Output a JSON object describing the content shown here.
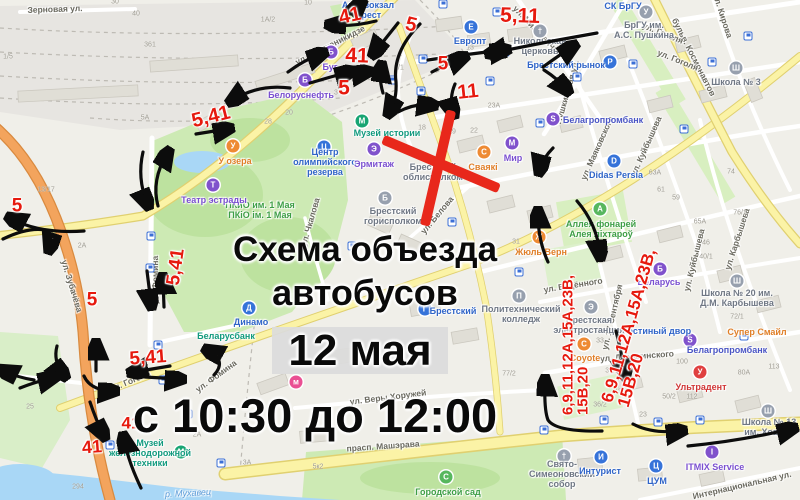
{
  "title": {
    "line1": "Схема объезда",
    "line2": "автобусов",
    "date": "12 мая",
    "time": "с 10:30 до 12:00"
  },
  "colors": {
    "route_red": "#e6190e",
    "cross_red": "#e8281b",
    "arrow_black": "#0c0c0c",
    "road_yellow": "#fbf3a6",
    "road_orange": "#f3a45d",
    "park_green": "#cdeab4",
    "water_blue": "#a9d7f6",
    "poi_blue": "#3673d9",
    "poi_violet": "#8052cc",
    "poi_orange": "#ee8a33",
    "poi_green": "#57b75e",
    "poi_teal": "#18a573",
    "poi_gray": "#97a0ae",
    "poi_red": "#e04040",
    "poi_pink": "#ea4f93"
  },
  "overlay": {
    "route_labels": [
      {
        "t": "41",
        "x": 350,
        "y": 16,
        "r": -12,
        "s": 20
      },
      {
        "t": "5",
        "x": 411,
        "y": 25,
        "r": 14,
        "s": 20
      },
      {
        "t": "5,11",
        "x": 520,
        "y": 16,
        "r": 2,
        "s": 21
      },
      {
        "t": "41",
        "x": 357,
        "y": 56,
        "r": 2,
        "s": 21
      },
      {
        "t": "5",
        "x": 344,
        "y": 88,
        "r": 0,
        "s": 21
      },
      {
        "t": "5",
        "x": 443,
        "y": 64,
        "r": 0,
        "s": 19
      },
      {
        "t": "11",
        "x": 468,
        "y": 92,
        "r": -6,
        "s": 20
      },
      {
        "t": "5,41",
        "x": 211,
        "y": 117,
        "r": -14,
        "s": 20
      },
      {
        "t": "5",
        "x": 17,
        "y": 206,
        "r": 0,
        "s": 19
      },
      {
        "t": "5,41",
        "x": 176,
        "y": 267,
        "r": -82,
        "s": 19
      },
      {
        "t": "5",
        "x": 92,
        "y": 300,
        "r": 0,
        "s": 19
      },
      {
        "t": "5,41",
        "x": 148,
        "y": 358,
        "r": -4,
        "s": 19
      },
      {
        "t": "41",
        "x": 131,
        "y": 423,
        "r": 0,
        "s": 17
      },
      {
        "t": "41",
        "x": 92,
        "y": 447,
        "r": -4,
        "s": 18
      },
      {
        "lines": [
          "6,9,11,12А,15А,23В,",
          "15В,20"
        ],
        "x": 576,
        "y": 345,
        "r": -90,
        "s": 15
      },
      {
        "lines": [
          "6,9,11,12А,15А,23В,",
          "15В,20"
        ],
        "x": 637,
        "y": 328,
        "r": -74,
        "s": 17
      }
    ],
    "arrows": [
      "M290,88 Q258,84 233,100",
      "M196,134 L227,129",
      "M143,152 Q137,178 147,203",
      "M158,206 Q151,180 167,154",
      "M147,271 L151,303",
      "M164,307 L163,280",
      "M84,231 Q40,234 12,219",
      "M3,239 Q28,227 45,230 Q53,238 50,247",
      "M96,371 L96,346",
      "M57,346 Q53,361 63,374",
      "M84,376 Q90,390 112,391",
      "M170,366 L134,372",
      "M145,377 L179,379",
      "M214,375 Q227,361 209,351",
      "M90,402 Q96,420 103,434",
      "M141,488 Q128,461 124,439",
      "M602,431 Q556,432 548,420 Q544,410 545,382",
      "M548,262 Q538,240 538,214",
      "M577,201 Q597,224 600,254",
      "M616,331 Q622,355 625,373",
      "M633,424 Q652,434 680,431",
      "M688,446 Q740,441 791,429",
      "M597,33 Q545,42 492,53",
      "M428,60 Q468,54 504,50",
      "M543,67 Q558,56 572,47",
      "M544,70 Q558,79 566,89",
      "M432,72 Q447,64 462,58",
      "M455,84 Q449,98 453,112",
      "M420,24 Q392,52 396,82 Q397,99 390,111",
      "M398,112 Q415,103 431,105",
      "M288,72 Q304,60 321,54",
      "M310,83 Q330,77 349,72",
      "M344,75 L366,72",
      "M376,21 Q352,27 332,25",
      "M350,14 L360,4",
      "M398,23 Q386,38 375,52",
      "M383,93 Q379,80 381,68",
      "M553,148 Q543,158 540,169",
      "M34,380 Q16,377 4,371",
      "M20,388 Q35,382 52,378"
    ]
  },
  "map": {
    "street_labels": [
      {
        "t": "Зерновая ул.",
        "x": 55,
        "y": 9,
        "r": -2
      },
      {
        "t": "ул. Орджоникидзе",
        "x": 330,
        "y": 45,
        "r": -27
      },
      {
        "t": "ул. Мицкевича",
        "x": 536,
        "y": 29,
        "r": 46
      },
      {
        "t": "ул. Кирова",
        "x": 723,
        "y": 16,
        "r": 72
      },
      {
        "t": "бульв. Космонавтов",
        "x": 694,
        "y": 57,
        "r": 63
      },
      {
        "t": "Пушкинская ул.",
        "x": 567,
        "y": 92,
        "r": -74
      },
      {
        "t": "ул. Маяковского",
        "x": 597,
        "y": 148,
        "r": -66
      },
      {
        "t": "ул. Куйбышева",
        "x": 646,
        "y": 146,
        "r": -66
      },
      {
        "t": "ул. Куйбышева",
        "x": 694,
        "y": 260,
        "r": -76
      },
      {
        "t": "ул. Карбышева",
        "x": 737,
        "y": 239,
        "r": -72
      },
      {
        "t": "ул. Гоголя",
        "x": 663,
        "y": 33,
        "r": 22
      },
      {
        "t": "ул. Гоголя",
        "x": 678,
        "y": 60,
        "r": 22
      },
      {
        "t": "ул. Белова",
        "x": 437,
        "y": 215,
        "r": -50
      },
      {
        "t": "ул. Зубачёва",
        "x": 72,
        "y": 286,
        "r": 73
      },
      {
        "t": "ул. Фомина",
        "x": 155,
        "y": 280,
        "r": -90
      },
      {
        "t": "ул. Фомина",
        "x": 216,
        "y": 376,
        "r": -36
      },
      {
        "t": "ул. Гоголя",
        "x": 130,
        "y": 381,
        "r": -23
      },
      {
        "t": "прасп. Машэрава",
        "x": 383,
        "y": 446,
        "r": -4
      },
      {
        "t": "ул. Веры Хоружей",
        "x": 388,
        "y": 397,
        "r": -7
      },
      {
        "t": "Интернациональная ул.",
        "x": 742,
        "y": 485,
        "r": -13
      },
      {
        "t": "ул. Будённого",
        "x": 573,
        "y": 285,
        "r": -9
      },
      {
        "t": "ул. 17 Сентября",
        "x": 612,
        "y": 317,
        "r": -77
      },
      {
        "t": "ул. Дзержинского",
        "x": 637,
        "y": 356,
        "r": -4
      },
      {
        "t": "ул. Чкалова",
        "x": 310,
        "y": 222,
        "r": -74
      },
      {
        "t": "р. Мухавец",
        "x": 188,
        "y": 493,
        "r": -3,
        "c": "water"
      }
    ],
    "pois": [
      {
        "lines": [
          "Автовокзал",
          "Брест"
        ],
        "lx": 368,
        "ly": 10,
        "lc": "#2f64c8"
      },
      {
        "label": "Европт",
        "lx": 470,
        "ly": 41,
        "lc": "#2f64c8",
        "ix": 471,
        "iy": 27,
        "bg": "#3673d9",
        "g": "Е"
      },
      {
        "lines": [
          "Никольская",
          "церковь"
        ],
        "lx": 540,
        "ly": 46,
        "lc": "#6f7784",
        "ix": 540,
        "iy": 31,
        "bg": "#97a0ae",
        "g": "†"
      },
      {
        "label": "Брестский рынок",
        "lx": 566,
        "ly": 65,
        "lc": "#2f64c8",
        "ix": 610,
        "iy": 62,
        "bg": "#3673d9",
        "g": "Р"
      },
      {
        "label": "СК БрГУ",
        "lx": 623,
        "ly": 6,
        "lc": "#2f64c8"
      },
      {
        "lines": [
          "БрГУ им.",
          "А.С. Пушкина"
        ],
        "lx": 644,
        "ly": 30,
        "lc": "#6f7784",
        "ix": 646,
        "iy": 12,
        "bg": "#97a0ae",
        "g": "У"
      },
      {
        "label": "Школа № 3",
        "lx": 736,
        "ly": 82,
        "lc": "#6f7784",
        "ix": 736,
        "iy": 68,
        "bg": "#97a0ae",
        "g": "Ш"
      },
      {
        "label": "Белагропромбанк",
        "lx": 603,
        "ly": 120,
        "lc": "#4a55c4",
        "ix": 553,
        "iy": 119,
        "bg": "#8052cc",
        "g": "S"
      },
      {
        "label": "Didas Persia",
        "lx": 616,
        "ly": 175,
        "lc": "#2f64c8",
        "ix": 614,
        "iy": 161,
        "bg": "#3673d9",
        "g": "D"
      },
      {
        "label": "Белоруснефть",
        "lx": 301,
        "ly": 95,
        "lc": "#7a4fd0",
        "ix": 305,
        "iy": 80,
        "bg": "#8052cc",
        "g": "Б"
      },
      {
        "label": "Буг",
        "lx": 330,
        "ly": 67,
        "lc": "#7a4fd0",
        "ix": 331,
        "iy": 52,
        "bg": "#8052cc",
        "g": "Б"
      },
      {
        "label": "Музей истории",
        "lx": 387,
        "ly": 133,
        "lc": "#119a7e",
        "ix": 362,
        "iy": 121,
        "bg": "#18a573",
        "g": "М"
      },
      {
        "lines": [
          "Центр",
          "олимпийского",
          "резерва"
        ],
        "lx": 325,
        "ly": 162,
        "lc": "#2f64c8",
        "ix": 324,
        "iy": 147,
        "bg": "#3673d9",
        "g": "Ц"
      },
      {
        "label": "Эрмитаж",
        "lx": 374,
        "ly": 164,
        "lc": "#7a4fd0",
        "ix": 374,
        "iy": 149,
        "bg": "#8052cc",
        "g": "Э"
      },
      {
        "lines": [
          "Брестский",
          "облисполком"
        ],
        "lx": 433,
        "ly": 172,
        "lc": "#6f7784"
      },
      {
        "lines": [
          "Брестский",
          "горисполком"
        ],
        "lx": 393,
        "ly": 216,
        "lc": "#6f7784",
        "ix": 385,
        "iy": 198,
        "bg": "#97a0ae",
        "g": "Б"
      },
      {
        "label": "Сваякі",
        "lx": 483,
        "ly": 167,
        "lc": "#e07f28",
        "ix": 484,
        "iy": 152,
        "bg": "#ee8a33",
        "g": "С"
      },
      {
        "label": "Мир",
        "lx": 513,
        "ly": 158,
        "lc": "#7a4fd0",
        "ix": 512,
        "iy": 143,
        "bg": "#8052cc",
        "g": "М"
      },
      {
        "lines": [
          "ПКиО им. 1 Мая",
          "ПКіО ім. 1 Мая"
        ],
        "lx": 260,
        "ly": 210,
        "lc": "#3d9e45"
      },
      {
        "label": "Театр эстрады",
        "lx": 214,
        "ly": 200,
        "lc": "#7a4fd0",
        "ix": 213,
        "iy": 185,
        "bg": "#8052cc",
        "g": "Т"
      },
      {
        "label": "У озера",
        "lx": 235,
        "ly": 161,
        "lc": "#e07f28",
        "ix": 233,
        "iy": 146,
        "bg": "#ee8a33",
        "g": "У"
      },
      {
        "label": "Динамо",
        "lx": 251,
        "ly": 322,
        "lc": "#2f64c8",
        "ix": 249,
        "iy": 308,
        "bg": "#3673d9",
        "g": "Д"
      },
      {
        "label": "Беларусбанк",
        "lx": 226,
        "ly": 336,
        "lc": "#119a7e"
      },
      {
        "lines": [
          "Музей",
          "железнодорожной",
          "техники"
        ],
        "lx": 150,
        "ly": 453,
        "lc": "#119a7e",
        "ix": 181,
        "iy": 452,
        "bg": "#18a573",
        "g": "М"
      },
      {
        "label": "Городской сад",
        "lx": 448,
        "ly": 492,
        "lc": "#3d9e45",
        "ix": 446,
        "iy": 477,
        "bg": "#57b75e",
        "g": "С"
      },
      {
        "label": "Жюль Верн",
        "lx": 541,
        "ly": 252,
        "lc": "#e07f28",
        "ix": 539,
        "iy": 237,
        "bg": "#ee8a33",
        "g": "Ж"
      },
      {
        "lines": [
          "Аллея фонарей",
          "Алея ліхтароў"
        ],
        "lx": 601,
        "ly": 229,
        "lc": "#3d9e45",
        "ix": 600,
        "iy": 209,
        "bg": "#57b75e",
        "g": "А"
      },
      {
        "label": "Беларусь",
        "lx": 659,
        "ly": 282,
        "lc": "#7a4fd0",
        "ix": 660,
        "iy": 269,
        "bg": "#8052cc",
        "g": "Б"
      },
      {
        "lines": [
          "Школа № 20 им.",
          "Д.М. Карбышева"
        ],
        "lx": 737,
        "ly": 298,
        "lc": "#6f7784",
        "ix": 737,
        "iy": 281,
        "bg": "#97a0ae",
        "g": "Ш"
      },
      {
        "label": "Белагропромбанк",
        "lx": 727,
        "ly": 350,
        "lc": "#4a55c4",
        "ix": 690,
        "iy": 340,
        "bg": "#8052cc",
        "g": "S"
      },
      {
        "label": "Супер Смайл",
        "lx": 757,
        "ly": 332,
        "lc": "#e07f28"
      },
      {
        "label": "Гостиный двор",
        "lx": 657,
        "ly": 331,
        "lc": "#2f64c8"
      },
      {
        "label": "Ультрадент",
        "lx": 701,
        "ly": 387,
        "lc": "#d03535",
        "ix": 700,
        "iy": 372,
        "bg": "#e04040",
        "g": "У"
      },
      {
        "label": "Coyote",
        "lx": 585,
        "ly": 358,
        "lc": "#e07f28",
        "ix": 584,
        "iy": 344,
        "bg": "#ee8a33",
        "g": "C"
      },
      {
        "lines": [
          "Брестская",
          "электростанция"
        ],
        "lx": 589,
        "ly": 325,
        "lc": "#6f7784",
        "ix": 591,
        "iy": 307,
        "bg": "#97a0ae",
        "g": "Э"
      },
      {
        "lines": [
          "Политехнический",
          "колледж"
        ],
        "lx": 521,
        "ly": 314,
        "lc": "#6f7784",
        "ix": 519,
        "iy": 296,
        "bg": "#97a0ae",
        "g": "П"
      },
      {
        "label": "Брестский",
        "lx": 453,
        "ly": 311,
        "lc": "#2f64c8",
        "ix": 425,
        "iy": 309,
        "bg": "#3673d9",
        "g": "Г"
      },
      {
        "lines": [
          "Свято-",
          "Симеоновский",
          "собор"
        ],
        "lx": 562,
        "ly": 474,
        "lc": "#6f7784",
        "ix": 564,
        "iy": 456,
        "bg": "#97a0ae",
        "g": "†"
      },
      {
        "label": "Интурист",
        "lx": 600,
        "ly": 471,
        "lc": "#2f64c8",
        "ix": 601,
        "iy": 457,
        "bg": "#3673d9",
        "g": "И"
      },
      {
        "label": "ЦУМ",
        "lx": 657,
        "ly": 481,
        "lc": "#2f64c8",
        "ix": 656,
        "iy": 466,
        "bg": "#3673d9",
        "g": "Ц"
      },
      {
        "label": "ITMIX Service",
        "lx": 715,
        "ly": 467,
        "lc": "#7a4fd0",
        "ix": 712,
        "iy": 452,
        "bg": "#8052cc",
        "g": "I"
      },
      {
        "lines": [
          "Школа № 13",
          "им. Хована"
        ],
        "lx": 769,
        "ly": 427,
        "lc": "#6f7784",
        "ix": 768,
        "iy": 411,
        "bg": "#97a0ae",
        "g": "Ш"
      },
      {
        "ix": 296,
        "iy": 382,
        "bg": "#ea4f93",
        "g": "м"
      }
    ],
    "house_numbers": [
      [
        "1А/2",
        268,
        20
      ],
      [
        "30",
        115,
        2
      ],
      [
        "40",
        136,
        14
      ],
      [
        "10",
        308,
        3
      ],
      [
        "1/5",
        8,
        57
      ],
      [
        "5А",
        145,
        118
      ],
      [
        "361",
        150,
        45
      ],
      [
        "28",
        268,
        122
      ],
      [
        "3",
        336,
        93
      ],
      [
        "20",
        289,
        113
      ],
      [
        "2/1",
        399,
        68
      ],
      [
        "13",
        470,
        48
      ],
      [
        "23А",
        494,
        106
      ],
      [
        "19",
        452,
        132
      ],
      [
        "22",
        474,
        131
      ],
      [
        "18",
        422,
        128
      ],
      [
        "31",
        516,
        242
      ],
      [
        "46",
        706,
        243
      ],
      [
        "40/1",
        706,
        257
      ],
      [
        "65А",
        700,
        222
      ],
      [
        "76/1",
        740,
        213
      ],
      [
        "74",
        731,
        172
      ],
      [
        "59",
        676,
        198
      ],
      [
        "61",
        661,
        190
      ],
      [
        "63А",
        655,
        173
      ],
      [
        "35/1",
        612,
        371
      ],
      [
        "43",
        618,
        392
      ],
      [
        "50/2",
        669,
        397
      ],
      [
        "112",
        692,
        397
      ],
      [
        "100",
        682,
        362
      ],
      [
        "80А",
        744,
        373
      ],
      [
        "113",
        774,
        367
      ],
      [
        "77/2",
        509,
        374
      ],
      [
        "5к2",
        318,
        467
      ],
      [
        "294",
        78,
        487
      ],
      [
        "2А",
        197,
        435
      ],
      [
        "3А",
        247,
        463
      ],
      [
        "15",
        182,
        382
      ],
      [
        "25",
        30,
        407
      ],
      [
        "13/17",
        46,
        190
      ],
      [
        "2А",
        82,
        246
      ],
      [
        "72/1",
        737,
        317
      ],
      [
        "33",
        600,
        341
      ],
      [
        "36/2",
        600,
        405
      ],
      [
        "23",
        643,
        415
      ]
    ],
    "bus_stops": [
      [
        443,
        4
      ],
      [
        497,
        12
      ],
      [
        423,
        59
      ],
      [
        505,
        52
      ],
      [
        490,
        81
      ],
      [
        392,
        80
      ],
      [
        421,
        91
      ],
      [
        424,
        108
      ],
      [
        540,
        123
      ],
      [
        452,
        222
      ],
      [
        519,
        272
      ],
      [
        352,
        246
      ],
      [
        146,
        204
      ],
      [
        151,
        236
      ],
      [
        150,
        268
      ],
      [
        158,
        345
      ],
      [
        163,
        380
      ],
      [
        110,
        445
      ],
      [
        188,
        414
      ],
      [
        221,
        463
      ],
      [
        544,
        430
      ],
      [
        604,
        420
      ],
      [
        658,
        422
      ],
      [
        700,
        420
      ],
      [
        748,
        36
      ],
      [
        712,
        62
      ],
      [
        684,
        129
      ],
      [
        633,
        64
      ],
      [
        577,
        77
      ],
      [
        744,
        336
      ]
    ]
  }
}
